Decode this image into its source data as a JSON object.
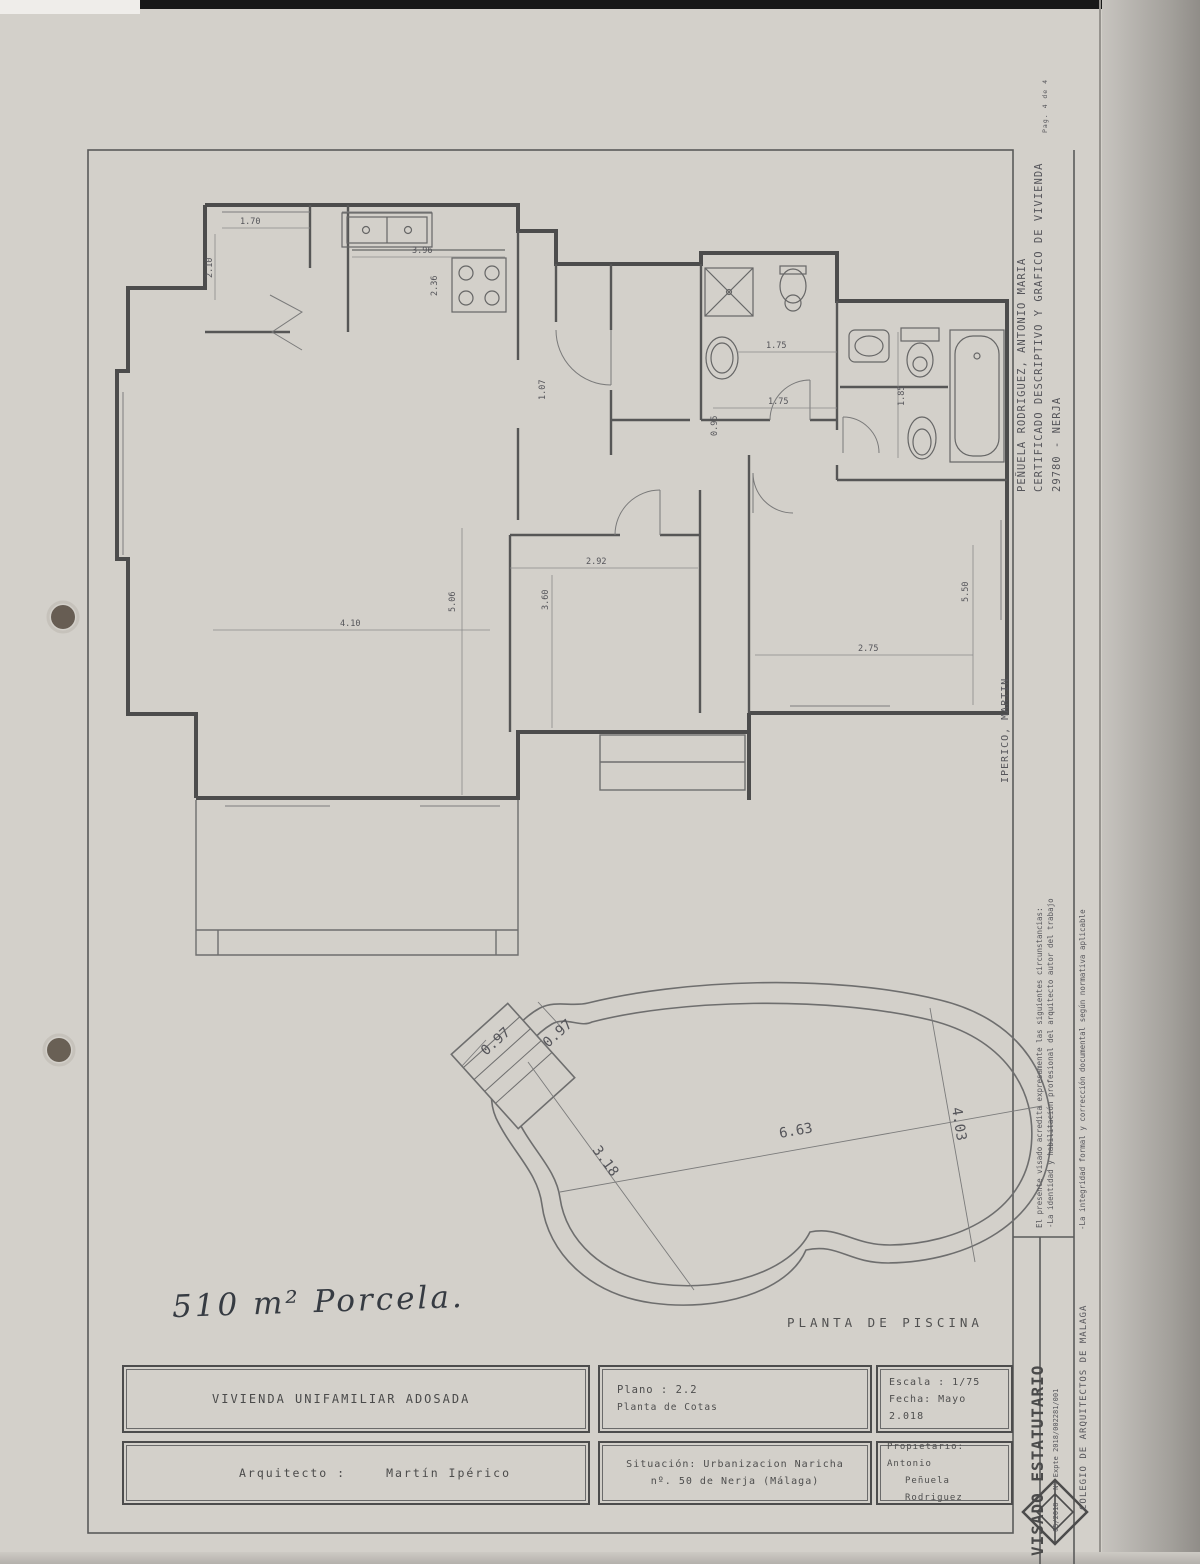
{
  "page_label": "Pag. 4 de 4",
  "handwritten_note": "510 m² Porcela.",
  "colors": {
    "paper": "#d3d0ca",
    "line_dark": "#4c4c4c",
    "line_mid": "#6b6b6b",
    "text": "#4e4e4e",
    "punch_hole": "#5d5349"
  },
  "margins": {
    "owner_line1": "PEÑUELA RODRIGUEZ, ANTONIO MARIA",
    "owner_line2": "CERTIFICADO DESCRIPTIVO Y GRAFICO DE VIVIENDA",
    "owner_line3": "29780 - NERJA",
    "architect_vertical": "IPERICO, MARTIN",
    "visado_line1": "El presente visado acredita expresamente las siguientes circunstancias:",
    "visado_line2": "-La identidad y habilitación profesional del arquitecto autor del trabajo",
    "visado_line3": "-La integridad formal y corrección documental según normativa aplicable",
    "visado_title": "VISADO ESTATUTARIO",
    "visado_expediente": "05/2018 - Nº Expte 2018/002281/001",
    "colegio": "COLEGIO DE ARQUITECTOS DE MALAGA"
  },
  "title_block": {
    "project": "VIVIENDA UNIFAMILIAR ADOSADA",
    "architect_label": "Arquitecto :",
    "architect_name": "Martín Ipérico",
    "plano_line1": "Plano : 2.2",
    "plano_line2": "Planta de Cotas",
    "situacion_line1": "Situación: Urbanizacion Naricha",
    "situacion_line2": "nº. 50 de Nerja (Málaga)",
    "escala": "Escala : 1/75",
    "fecha": "Fecha: Mayo 2.018",
    "propietario_line1": "Propietario: Antonio",
    "propietario_line2": "Peñuela Rodriguez"
  },
  "plan_dims": [
    "1.70",
    "2.10",
    "3.96",
    "2.36",
    "1.07",
    "1.75",
    "1.75",
    "0.95",
    "1.85",
    "2.92",
    "3.60",
    "4.10",
    "5.06",
    "5.50",
    "2.75"
  ],
  "pool": {
    "caption": "PLANTA DE PISCINA",
    "dims": [
      "0.97",
      "0.97",
      "6.63",
      "3.18",
      "4.03"
    ]
  }
}
